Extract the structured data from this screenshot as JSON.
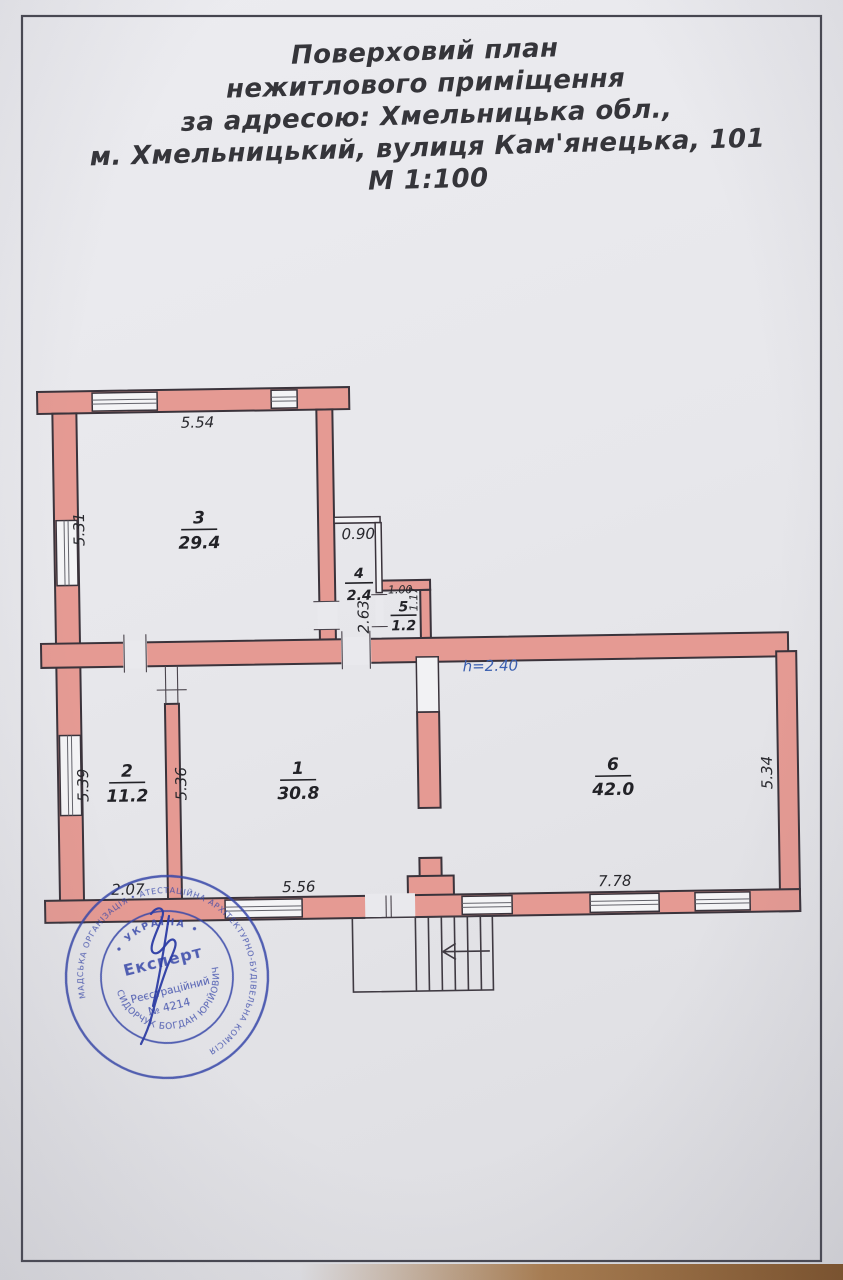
{
  "page": {
    "title_lines": [
      "Поверховий план",
      "нежитлового приміщення",
      "за адресою: Хмельницька обл.,",
      "м. Хмельницький, вулиця Кам'янецька, 101",
      "М 1:100"
    ]
  },
  "plan": {
    "height_note": "h=2.40",
    "rooms": [
      {
        "number": "1",
        "area": "30.8"
      },
      {
        "number": "2",
        "area": "11.2"
      },
      {
        "number": "3",
        "area": "29.4"
      },
      {
        "number": "4",
        "area": "2.4"
      },
      {
        "number": "5",
        "area": "1.2"
      },
      {
        "number": "6",
        "area": "42.0"
      }
    ],
    "dimensions": {
      "room3_top": "5.54",
      "room3_left": "5.31",
      "room4_top": "0.90",
      "room4_left": "2.63",
      "room5_top": "1.00",
      "room5_right": "1.17",
      "room2_left": "5.39",
      "room2_bottom": "2.07",
      "room1_left": "5.36",
      "room1_bottom": "5.56",
      "room6_right": "5.34",
      "room6_bottom": "7.78"
    }
  },
  "stamp": {
    "center_line1": "Експерт",
    "center_line2": "Реєстраційний",
    "center_line3": "№ 4214",
    "ring_inner_top": "• УКРАЇНА •",
    "ring_inner_bottom": "СИДОРЧУК БОГДАН ЮРІЙОВИЧ",
    "ring_outer": "• ВСЕУКРАЇНСЬКА ГРОМАДСЬКА ОРГАНІЗАЦІЯ • АТЕСТАЦІЙНА АРХІТЕКТУРНО-БУДІВЕЛЬНА КОМІСІЯ"
  },
  "colors": {
    "wall_fill": "#e59a93",
    "outline": "#3a333b",
    "paper": "#e9e9ed",
    "stamp_blue": "#3747a9",
    "note_blue": "#3a5fb0"
  }
}
